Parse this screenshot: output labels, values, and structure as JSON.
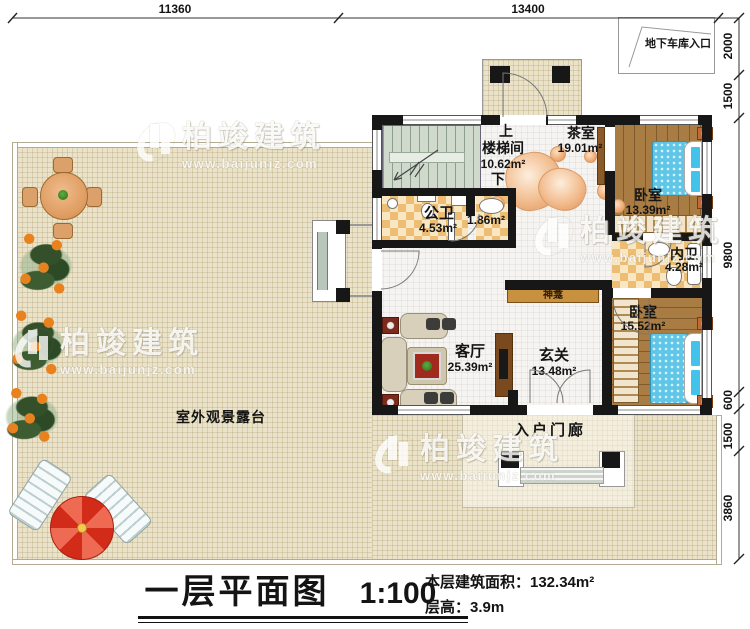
{
  "watermark": {
    "brand": "柏竣建筑",
    "url": "www.baijunjz.com"
  },
  "dimensions": {
    "top": [
      "11360",
      "13400"
    ],
    "right": [
      "2000",
      "1500",
      "9800",
      "600",
      "1500",
      "3860"
    ]
  },
  "garage": {
    "label": "地下车库入口"
  },
  "rooms": {
    "stairwell": {
      "name": "楼梯间",
      "area": "10.62m²",
      "up": "上",
      "down": "下"
    },
    "tea_room": {
      "name": "茶室",
      "area": "19.01m²"
    },
    "bedroom_top": {
      "name": "卧室",
      "area": "13.39m²"
    },
    "public_bath": {
      "name": "公卫",
      "area": "4.53m²"
    },
    "wash_area": {
      "area": "1.86m²"
    },
    "ensuite_bath": {
      "name": "内卫",
      "area": "4.28m²"
    },
    "living_room": {
      "name": "客厅",
      "area": "25.39m²"
    },
    "foyer": {
      "name": "玄关",
      "area": "13.48m²"
    },
    "bedroom_bottom": {
      "name": "卧室",
      "area": "15.52m²"
    },
    "shrine": {
      "name": "神龛"
    },
    "entry_porch": {
      "name": "入户门廊"
    },
    "terrace": {
      "name": "室外观景露台"
    }
  },
  "title_block": {
    "title": "一层平面图",
    "scale": "1:100",
    "area_line": "本层建筑面积：132.34m²",
    "height_line": "层高：3.9m"
  },
  "colors": {
    "wall": "#171717",
    "terrace": "#ebe3c9",
    "wood": "#a87c42",
    "tile_dark": "#ecbd72",
    "tile_light": "#f8e7c2",
    "stair": "#cfdacd",
    "bed": "#5fc6e8",
    "umbrella": "#d22b1a"
  }
}
